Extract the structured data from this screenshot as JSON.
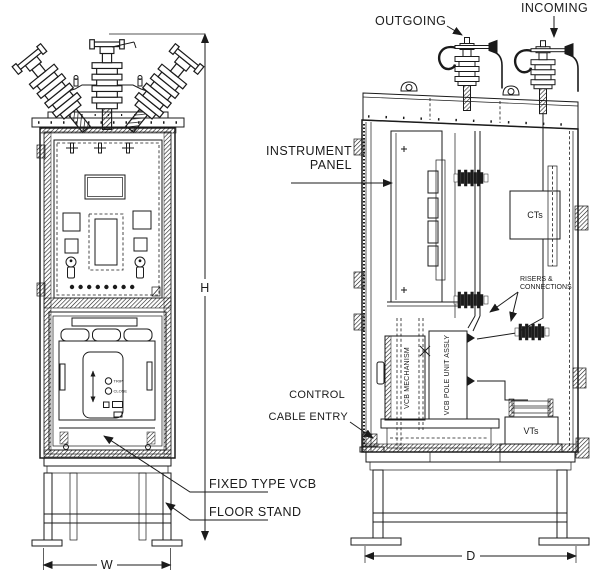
{
  "drawing": {
    "kind": "switchgear-outline-two-views",
    "views": [
      "front",
      "side"
    ]
  },
  "colors": {
    "line": "#1b1b1b",
    "background": "#ffffff"
  },
  "front_view": {
    "dimension_height": "H",
    "dimension_width": "W",
    "callouts": {
      "fixed_type_vcb": "FIXED TYPE VCB",
      "floor_stand": "FLOOR STAND"
    },
    "vcb_controls": {
      "trip": "TRIP",
      "close": "CLOSE"
    }
  },
  "side_view": {
    "dimension_depth": "D",
    "callouts": {
      "outgoing": "OUTGOING",
      "incoming": "INCOMING",
      "instrument_panel": [
        "INSTRUMENT",
        "PANEL"
      ],
      "risers_connections": [
        "RISERS &",
        "CONNECTIONS"
      ],
      "control_cable_entry": [
        "CONTROL",
        "CABLE ENTRY"
      ]
    },
    "components": {
      "cts": "CTs",
      "vts": "VTs",
      "vcb_mechanism": "VCB MECHANISM",
      "vcb_pole_unit": "VCB POLE UNIT ASSLY"
    }
  }
}
